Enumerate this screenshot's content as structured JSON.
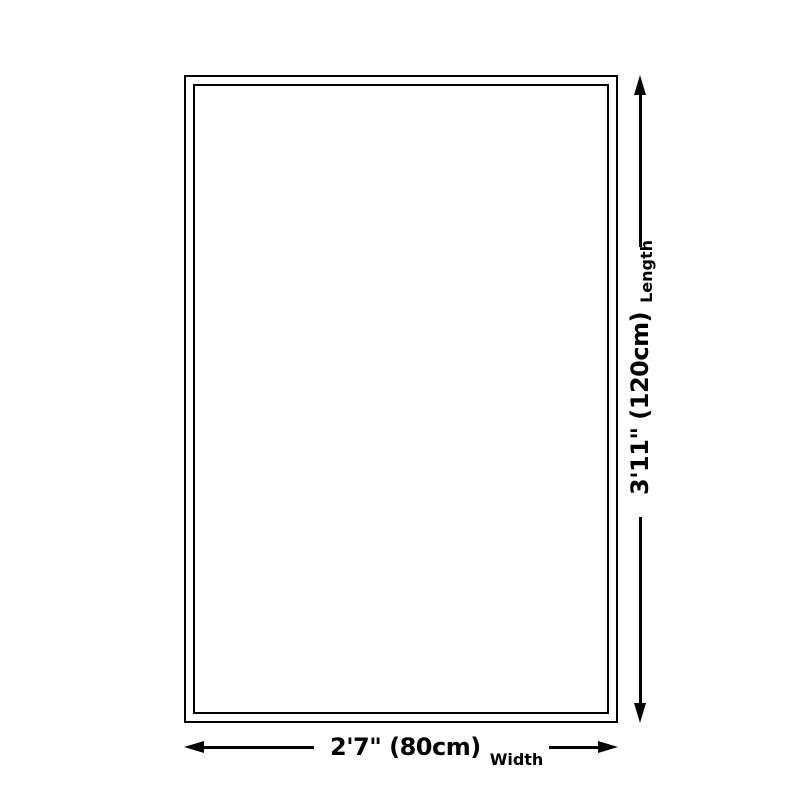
{
  "diagram": {
    "length": {
      "value": "3'11\" (120cm)",
      "label": "Length"
    },
    "width": {
      "value": "2'7\" (80cm)",
      "label": "Width"
    },
    "line_color": "#000000",
    "background_color": "#ffffff"
  }
}
